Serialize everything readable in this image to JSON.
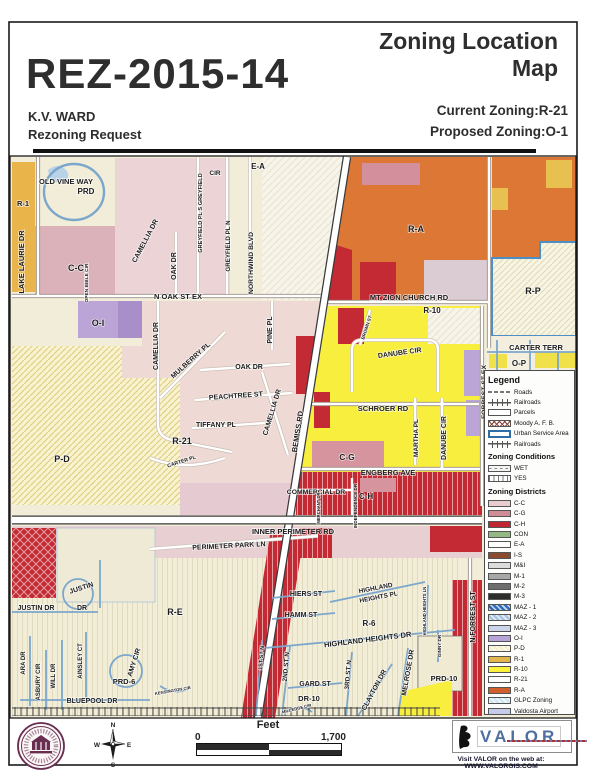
{
  "header": {
    "case_number": "REZ-2015-14",
    "map_title": "Zoning Location Map",
    "applicant": "K.V. WARD",
    "request": "Rezoning Request",
    "current_zoning": "Current Zoning:R-21",
    "proposed_zoning": "Proposed Zoning:O-1"
  },
  "legend": {
    "title": "Legend",
    "base_items": [
      {
        "label": "Roads",
        "swatch": "road-line"
      },
      {
        "label": "Railroads",
        "swatch": "railroad-line"
      },
      {
        "label": "Parcels",
        "swatch": "parcel-box"
      },
      {
        "label": "Moody A. F. B.",
        "swatch": "x-hatch"
      },
      {
        "label": "Urban Service Area",
        "swatch": "blue-border"
      },
      {
        "label": "Railroads",
        "swatch": "railroad-line"
      }
    ],
    "conditions_title": "Zoning Conditions",
    "conditions": [
      {
        "label": "WET",
        "swatch": "dash-pattern"
      },
      {
        "label": "YES",
        "swatch": "vline-pattern"
      }
    ],
    "districts_title": "Zoning Districts",
    "districts": [
      {
        "label": "C-C",
        "color": "#e8ccd0"
      },
      {
        "label": "C-G",
        "color": "#cf8e96"
      },
      {
        "label": "C-H",
        "color": "#bf2630"
      },
      {
        "label": "CON",
        "color": "#93b881"
      },
      {
        "label": "E-A",
        "color": "#fdfdfd"
      },
      {
        "label": "I-S",
        "color": "#8a4c2c"
      },
      {
        "label": "M&I",
        "color": "#dcdcdc"
      },
      {
        "label": "M-1",
        "color": "#a8a8a8"
      },
      {
        "label": "M-2",
        "color": "#6e6e6e"
      },
      {
        "label": "M-3",
        "color": "#2e2e2a"
      },
      {
        "label": "MAZ - 1",
        "color": "#2f6eb5",
        "hatch": true
      },
      {
        "label": "MAZ - 2",
        "color": "#a9c4e2",
        "hatch": true
      },
      {
        "label": "MAZ - 3",
        "color": "#ccd4ec"
      },
      {
        "label": "O-I",
        "color": "#b9a4d9"
      },
      {
        "label": "P-D",
        "color": "#f6f0cc",
        "hatch": true
      },
      {
        "label": "R-1",
        "color": "#e3b54d"
      },
      {
        "label": "R-10",
        "color": "#fbf23c"
      },
      {
        "label": "R-21",
        "color": "#fdfdfd"
      },
      {
        "label": "R-A",
        "color": "#cf5f2c"
      },
      {
        "label": "GLPC Zoning",
        "color": "#cfe8f2",
        "hatch": true
      },
      {
        "label": "Valdosta Airport",
        "color": "#c5cbe9"
      }
    ]
  },
  "scale": {
    "unit_label": "Feet",
    "start": "0",
    "end": "1,700"
  },
  "compass": {
    "n": "N",
    "s": "S",
    "e": "E",
    "w": "W"
  },
  "branding": {
    "logo_text": "VALOR",
    "visit_line": "Visit VALOR on the web at: WWW.VALORGIS.COM"
  },
  "map": {
    "area_labels": [
      {
        "t": "R-1",
        "x": 23,
        "y": 206,
        "s": 7.5
      },
      {
        "t": "C-C",
        "x": 76,
        "y": 271,
        "s": 9
      },
      {
        "t": "E-A",
        "x": 258,
        "y": 169,
        "s": 8
      },
      {
        "t": "R-A",
        "x": 416,
        "y": 232,
        "s": 9
      },
      {
        "t": "R-P",
        "x": 533,
        "y": 294,
        "s": 9
      },
      {
        "t": "R-10",
        "x": 432,
        "y": 313,
        "s": 8
      },
      {
        "t": "O-I",
        "x": 98,
        "y": 326,
        "s": 9
      },
      {
        "t": "P-D",
        "x": 62,
        "y": 462,
        "s": 9
      },
      {
        "t": "R-21",
        "x": 182,
        "y": 444,
        "s": 9
      },
      {
        "t": "C-G",
        "x": 347,
        "y": 460,
        "s": 8.5
      },
      {
        "t": "C-H",
        "x": 366,
        "y": 499,
        "s": 8,
        "c": "#6d0f16"
      },
      {
        "t": "O-P",
        "x": 519,
        "y": 366,
        "s": 8
      },
      {
        "t": "PRD",
        "x": 86,
        "y": 194,
        "s": 8
      },
      {
        "t": "R-E",
        "x": 175,
        "y": 615,
        "s": 9
      },
      {
        "t": "R-6",
        "x": 369,
        "y": 626,
        "s": 8
      },
      {
        "t": "PRD-6",
        "x": 124,
        "y": 684,
        "s": 7.5
      },
      {
        "t": "PRD-10",
        "x": 444,
        "y": 681,
        "s": 7.5
      },
      {
        "t": "DR-10",
        "x": 309,
        "y": 701,
        "s": 7.5
      }
    ],
    "street_labels": [
      {
        "t": "OLD VINE WAY",
        "x": 66,
        "y": 184,
        "s": 7.5
      },
      {
        "t": "LAKE LAURIE DR",
        "x": 24,
        "y": 262,
        "r": -90,
        "s": 7.5
      },
      {
        "t": "OPEN BIBLE CIR",
        "x": 88,
        "y": 283,
        "r": -90,
        "s": 4.8
      },
      {
        "t": "CAMELLIA DR",
        "x": 147,
        "y": 242,
        "r": -62,
        "s": 7
      },
      {
        "t": "OAK DR",
        "x": 176,
        "y": 266,
        "r": -90,
        "s": 7
      },
      {
        "t": "CIR",
        "x": 215,
        "y": 175,
        "s": 6.5
      },
      {
        "t": "GREYFIELD PL S GREYFIELD",
        "x": 202,
        "y": 213,
        "r": -90,
        "s": 5.6
      },
      {
        "t": "GREYFIELD PL N",
        "x": 230,
        "y": 246,
        "r": -90,
        "s": 6.2
      },
      {
        "t": "NORTHWIND BLVD",
        "x": 253,
        "y": 263,
        "r": -90,
        "s": 6.8
      },
      {
        "t": "N OAK ST EX",
        "x": 178,
        "y": 299,
        "s": 7.5
      },
      {
        "t": "MT ZION CHURCH RD",
        "x": 409,
        "y": 300,
        "s": 7.5
      },
      {
        "t": "CAMELLIA DR",
        "x": 158,
        "y": 346,
        "r": -90,
        "s": 7
      },
      {
        "t": "MULBERRY PL",
        "x": 192,
        "y": 362,
        "r": -42,
        "s": 7
      },
      {
        "t": "PINE PL",
        "x": 272,
        "y": 330,
        "r": -90,
        "s": 7
      },
      {
        "t": "OAK DR",
        "x": 249,
        "y": 369,
        "s": 7
      },
      {
        "t": "PEACHTREE ST",
        "x": 236,
        "y": 398,
        "r": -4,
        "s": 7
      },
      {
        "t": "TIFFANY PL",
        "x": 216,
        "y": 427,
        "s": 7
      },
      {
        "t": "CAMELLIA DR",
        "x": 274,
        "y": 413,
        "r": -73,
        "s": 7
      },
      {
        "t": "CARTER PL",
        "x": 182,
        "y": 463,
        "r": -18,
        "s": 5.2
      },
      {
        "t": "BEMISS RD",
        "x": 300,
        "y": 432,
        "r": -81,
        "s": 7.5
      },
      {
        "t": "SCHROER RD",
        "x": 383,
        "y": 411,
        "s": 7.5
      },
      {
        "t": "MARTHA PL",
        "x": 418,
        "y": 438,
        "r": -90,
        "s": 6.5
      },
      {
        "t": "DANUBE CIR",
        "x": 400,
        "y": 355,
        "r": -8,
        "s": 7
      },
      {
        "t": "DANUBE CIR",
        "x": 446,
        "y": 438,
        "r": -90,
        "s": 7
      },
      {
        "t": "BROWN ST",
        "x": 368,
        "y": 328,
        "r": -72,
        "s": 4.6
      },
      {
        "t": "FORREST ST EX",
        "x": 486,
        "y": 392,
        "r": -90,
        "s": 6.8
      },
      {
        "t": "CARTER TERR",
        "x": 536,
        "y": 350,
        "s": 7.5
      },
      {
        "t": "ENGBERG AVE",
        "x": 388,
        "y": 475,
        "s": 7.5
      },
      {
        "t": "COMMERCIAL DR",
        "x": 316,
        "y": 494,
        "s": 6.8
      },
      {
        "t": "INDEPENDENCE DR",
        "x": 357,
        "y": 506,
        "r": -90,
        "s": 4.6
      },
      {
        "t": "MERCHANT DR",
        "x": 320,
        "y": 508,
        "r": -90,
        "s": 4.2
      },
      {
        "t": "INNER PERIMETER RD",
        "x": 293,
        "y": 534,
        "s": 7.5
      },
      {
        "t": "PERIMETER PARK LN",
        "x": 229,
        "y": 548,
        "r": -3,
        "s": 7
      },
      {
        "t": "JUSTIN",
        "x": 82,
        "y": 590,
        "r": -18,
        "s": 7
      },
      {
        "t": "JUSTIN DR",
        "x": 36,
        "y": 610,
        "s": 7
      },
      {
        "t": "DR",
        "x": 82,
        "y": 610,
        "s": 7
      },
      {
        "t": "ARA DR",
        "x": 25,
        "y": 663,
        "r": -90,
        "s": 6
      },
      {
        "t": "ASBURY CIR",
        "x": 40,
        "y": 682,
        "r": -90,
        "s": 6
      },
      {
        "t": "WILL DR",
        "x": 55,
        "y": 676,
        "r": -90,
        "s": 6
      },
      {
        "t": "AINSLEY CT",
        "x": 82,
        "y": 661,
        "r": -90,
        "s": 6
      },
      {
        "t": "AMY CIR",
        "x": 136,
        "y": 663,
        "r": -72,
        "s": 7
      },
      {
        "t": "BLUEPOOL DR",
        "x": 92,
        "y": 703,
        "s": 7
      },
      {
        "t": "KENSINGTON CIR",
        "x": 173,
        "y": 692,
        "r": -10,
        "s": 4.2
      },
      {
        "t": "MILLEDGE CIR",
        "x": 297,
        "y": 710,
        "r": -14,
        "s": 4.2
      },
      {
        "t": "HIERS ST",
        "x": 306,
        "y": 596,
        "s": 7
      },
      {
        "t": "HAMM ST",
        "x": 301,
        "y": 617,
        "s": 7
      },
      {
        "t": "HIGHLAND",
        "x": 376,
        "y": 590,
        "r": -11,
        "s": 6.5
      },
      {
        "t": "HEIGHTS PL",
        "x": 379,
        "y": 599,
        "r": -11,
        "s": 6.5
      },
      {
        "t": "HIGHLAND HEIGHTS DR",
        "x": 368,
        "y": 642,
        "r": -7,
        "s": 7.5
      },
      {
        "t": "HIGHLAND HEIGHTS LN",
        "x": 426,
        "y": 611,
        "r": -90,
        "s": 4.2
      },
      {
        "t": "N FORREST ST",
        "x": 475,
        "y": 617,
        "r": -90,
        "s": 7
      },
      {
        "t": "1ST ST N",
        "x": 263,
        "y": 658,
        "r": -85,
        "s": 5.5
      },
      {
        "t": "2ND ST N",
        "x": 288,
        "y": 667,
        "r": -85,
        "s": 6.5
      },
      {
        "t": "GARD ST",
        "x": 315,
        "y": 686,
        "s": 7
      },
      {
        "t": "3RD ST N",
        "x": 350,
        "y": 675,
        "r": -85,
        "s": 6.5
      },
      {
        "t": "CLAYTON DR",
        "x": 376,
        "y": 691,
        "r": -62,
        "s": 7
      },
      {
        "t": "MELROSE DR",
        "x": 410,
        "y": 673,
        "r": -80,
        "s": 7
      },
      {
        "t": "GINNY DR",
        "x": 441,
        "y": 646,
        "r": -90,
        "s": 4.6
      }
    ]
  }
}
